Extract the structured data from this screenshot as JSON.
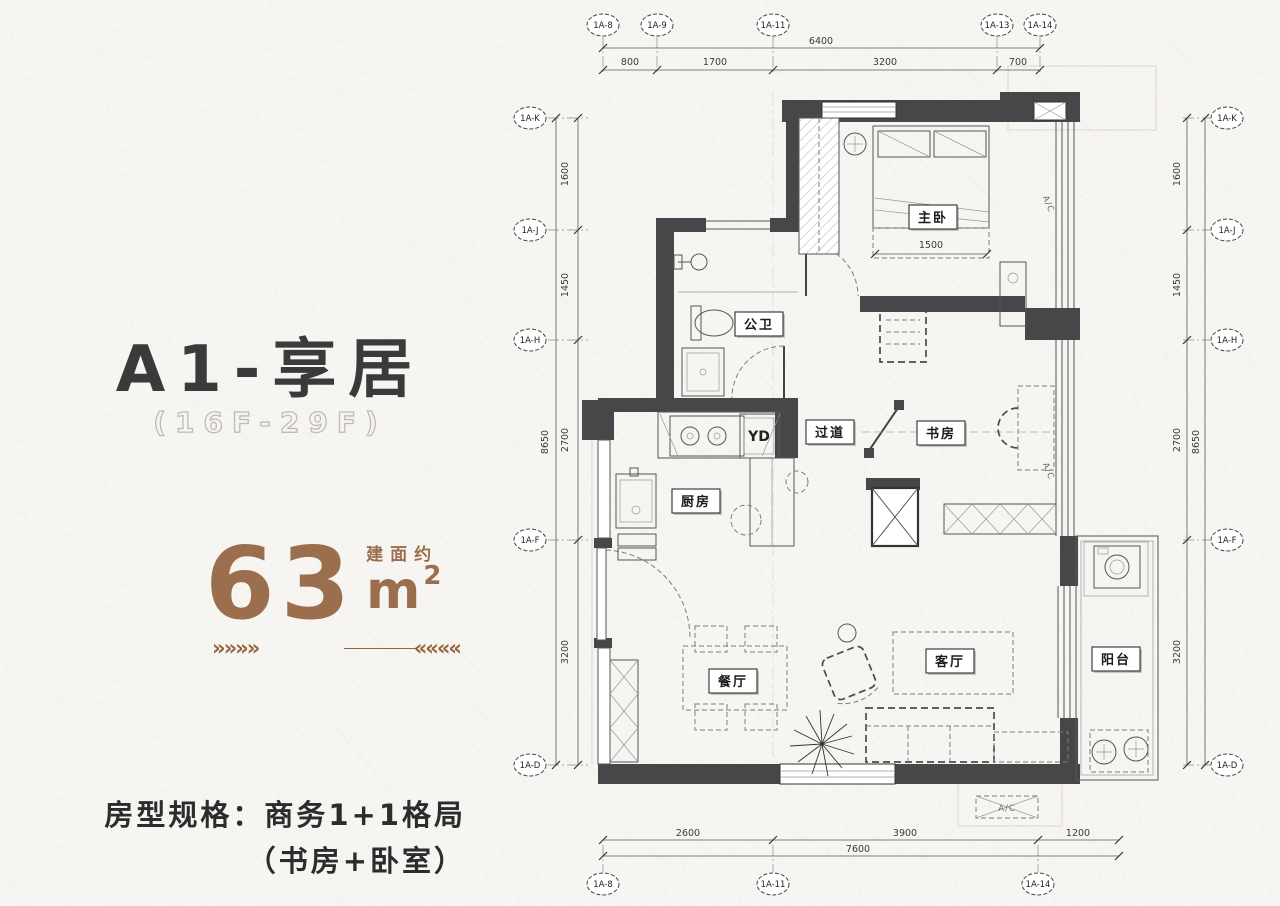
{
  "colors": {
    "accent": "#9b6e4d",
    "wall": "#474749",
    "title": "#3a3a3a"
  },
  "left_panel": {
    "title": "A1-享居",
    "floor_range": "(16F-29F)",
    "area": {
      "value": "63",
      "approx_label": "建面约",
      "unit": "m",
      "sup": "2"
    },
    "arrows_right": "»»»»",
    "arrows_left": "««««",
    "spec_line1": "房型规格：商务1+1格局",
    "spec_line2": "（书房+卧室）"
  },
  "plan": {
    "top_axes": [
      "1A-8",
      "1A-9",
      "1A-11",
      "1A-13",
      "1A-14"
    ],
    "bottom_axes": [
      "1A-8",
      "1A-11",
      "1A-14"
    ],
    "v_axes": [
      "1A-K",
      "1A-J",
      "1A-H",
      "1A-F",
      "1A-D"
    ],
    "dims": {
      "top_total": "6400",
      "top_segments": [
        "800",
        "1700",
        "3200",
        "700"
      ],
      "bottom_total": "7600",
      "bottom_segments": [
        "2600",
        "3900",
        "1200"
      ],
      "side_total": "8650",
      "side_segments": [
        "1600",
        "1450",
        "2700",
        "3200"
      ],
      "bed_width": "1500"
    },
    "rooms": {
      "master_bedroom": "主卧",
      "bathroom": "公卫",
      "kitchen": "厨房",
      "corridor": "过道",
      "study": "书房",
      "dining": "餐厅",
      "living": "客厅",
      "balcony": "阳台"
    },
    "annotations": {
      "ac": "A/C",
      "yd": "YD"
    }
  }
}
